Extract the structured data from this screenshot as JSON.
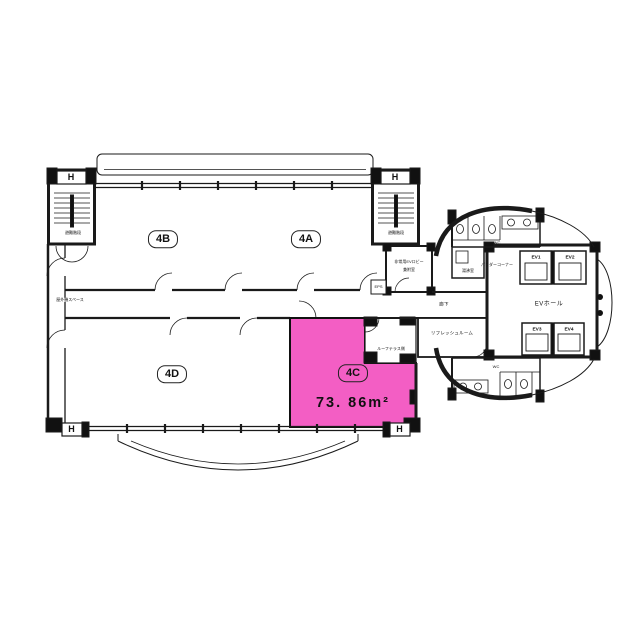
{
  "plan": {
    "highlight_color": "#f35ec4",
    "units": [
      {
        "label": "4B"
      },
      {
        "label": "4A"
      },
      {
        "label": "4D"
      },
      {
        "label": "4C"
      }
    ],
    "highlight": {
      "unit": "4C",
      "area_text": "73. 86m²"
    },
    "labels": {
      "hydrant": "H",
      "stair_left": "避難階段",
      "stair_right": "避難階段",
      "outdoor_space": "屋外機スペース",
      "emergency_lobby_1": "非常用EVロビー",
      "emergency_lobby_2": "兼附室",
      "eps": "EPS",
      "corridor": "廊下",
      "refresh_room": "リフレッシュルーム",
      "roof_terrace": "ルーフテラス側",
      "wc_top": "WC",
      "wc_bottom": "WC",
      "kitchenette": "湯沸室",
      "powder_corner": "パウダーコーナー",
      "ev_hall": "EVホール",
      "elevators": [
        "EV1",
        "EV2",
        "EV3",
        "EV4"
      ]
    }
  }
}
